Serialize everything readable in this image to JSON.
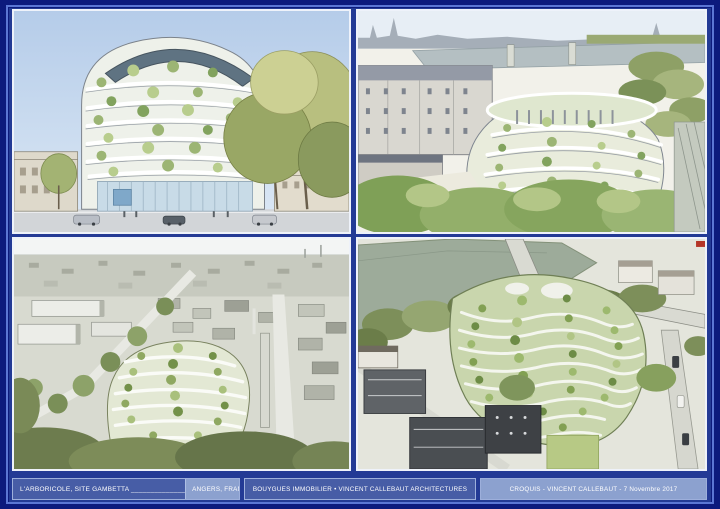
{
  "sheet": {
    "frame_color": "#0c1a7d",
    "pinstripe_color": "#5b76d4",
    "board_background": "#233a95",
    "panel_border_color": "#eef2fa",
    "caption_box_color": "#475da6",
    "caption_light_color": "#8ca1cf",
    "caption_text_color": "#ffffff"
  },
  "caption_bar": {
    "project_label": "L'ARBORICOLE, SITE GAMBETTA ______________",
    "location_label": "ANGERS, FRANCE",
    "client_label": "BOUYGUES IMMOBILIER • VINCENT CALLEBAUT ARCHITECTURES",
    "credit_label": "CROQUIS - VINCENT CALLEBAUT - 7 Novembre 2017"
  },
  "panels": [
    {
      "id": "top-left",
      "description": "street-level sketch of terraced green tower with large trees"
    },
    {
      "id": "top-right",
      "description": "bird's-eye sketch of terraced building beside river and city blocks"
    },
    {
      "id": "bottom-left",
      "description": "high aerial sketch of city with green tower at center"
    },
    {
      "id": "bottom-right",
      "description": "close aerial sketch of wavy green terraces near river"
    }
  ]
}
